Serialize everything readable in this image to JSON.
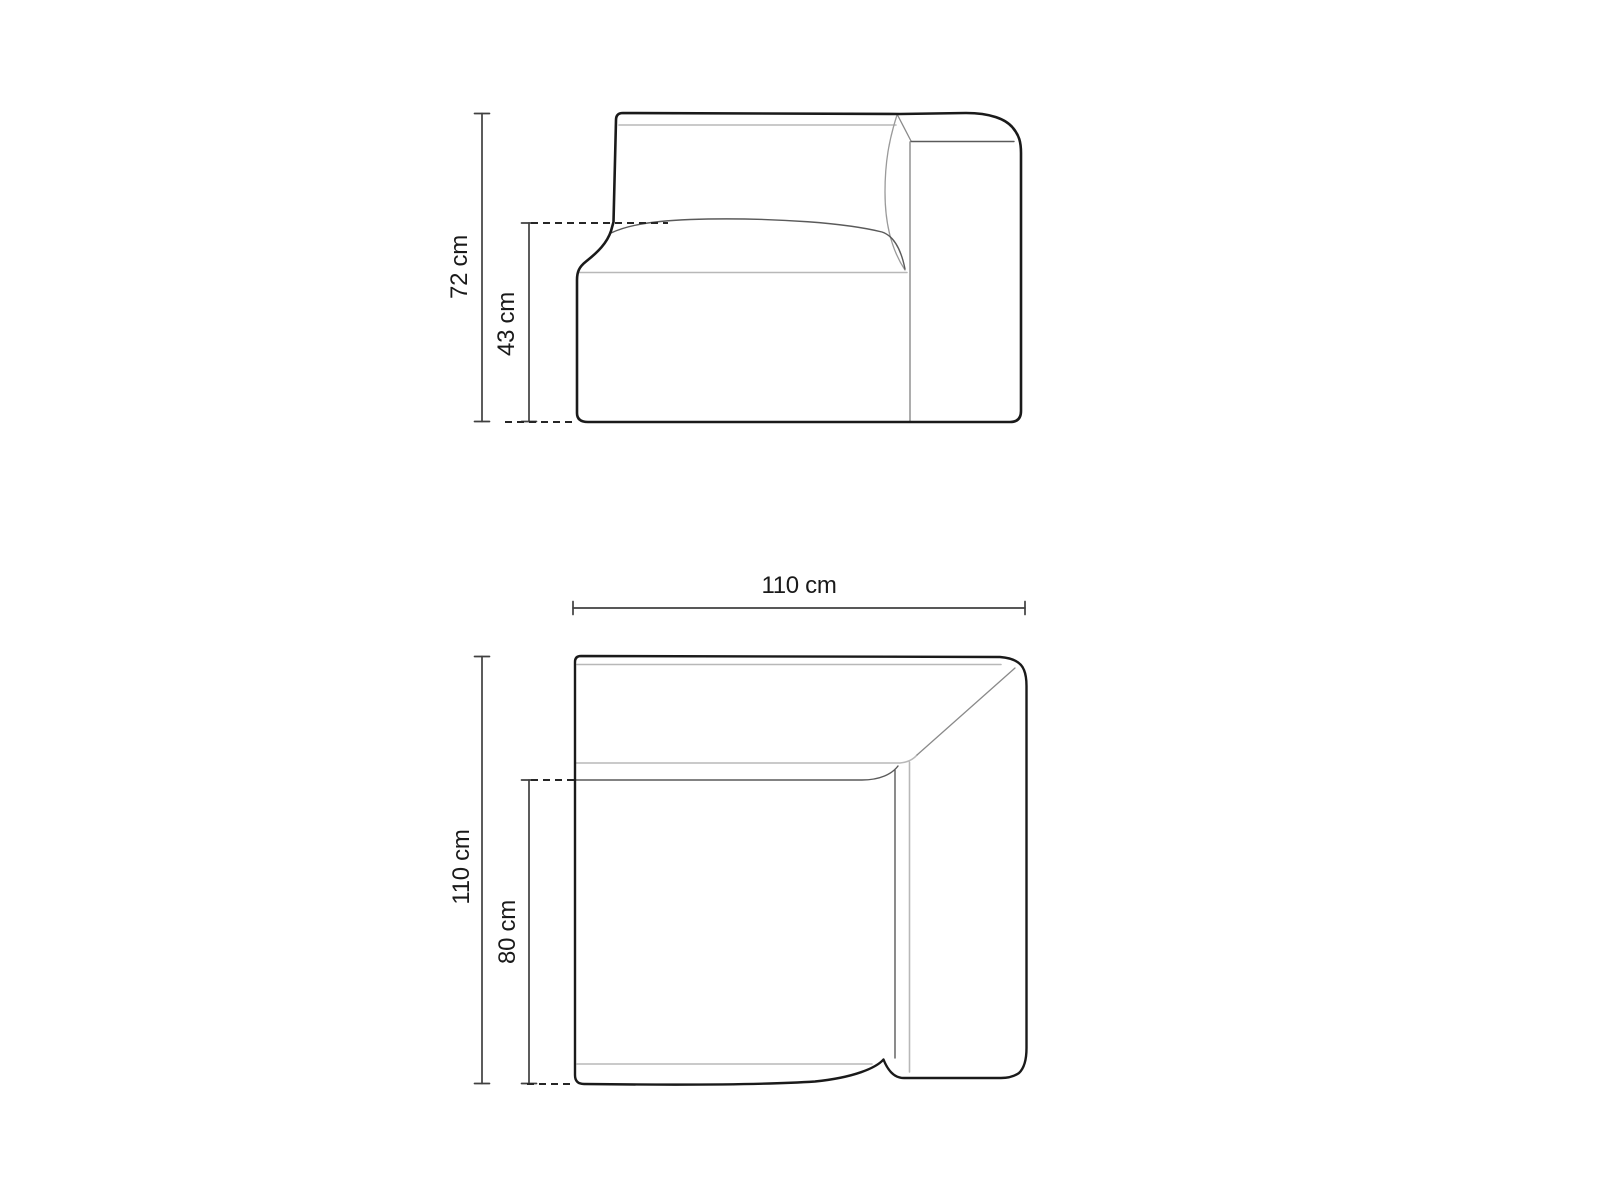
{
  "diagram": {
    "kind": "furniture-dimension-drawing",
    "subject": "corner sofa module",
    "views": [
      {
        "id": "side-elevation",
        "dimensions": [
          {
            "id": "total-height",
            "label": "72 cm",
            "value": 72,
            "unit": "cm"
          },
          {
            "id": "seat-height",
            "label": "43 cm",
            "value": 43,
            "unit": "cm"
          }
        ]
      },
      {
        "id": "top-plan",
        "dimensions": [
          {
            "id": "width",
            "label": "110 cm",
            "value": 110,
            "unit": "cm"
          },
          {
            "id": "depth",
            "label": "110 cm",
            "value": 110,
            "unit": "cm"
          },
          {
            "id": "seat-depth",
            "label": "80 cm",
            "value": 80,
            "unit": "cm"
          }
        ]
      }
    ],
    "colors": {
      "background": "#ffffff",
      "outline": "#1a1a1a",
      "dimension_line": "#404040",
      "dashed_line": "#262626",
      "seam_light": "#b8b8b8",
      "seam_medium": "#8a8a8a",
      "seam_dark": "#5a5a5a",
      "text": "#1a1a1a"
    }
  }
}
